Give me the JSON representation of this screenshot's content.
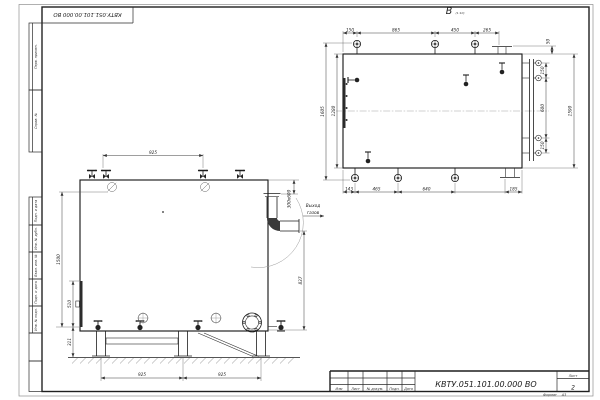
{
  "drawing": {
    "top_stamp_designation": "КВТУ.051.101.00.000 ВО"
  },
  "side_labels": [
    "Перв. примен.",
    "Справ. №",
    "Подп. и дата",
    "Инв. № дубл.",
    "Взам. инв. №",
    "Подп. и дата",
    "Инв. № подл."
  ],
  "view_b": {
    "label": "В",
    "label_note": "(1:10)",
    "dims_top": [
      "150",
      "865",
      "450",
      "265"
    ],
    "dim_flange_offset": "50",
    "dims_right": [
      "150",
      "600",
      "150"
    ],
    "dim_right_overall": "1590",
    "dims_left": [
      "1605",
      "1280"
    ],
    "dims_bottom": [
      "143",
      "465",
      "640",
      "185"
    ]
  },
  "view_front": {
    "dim_top": "925",
    "dim_left_overall": "1500",
    "dims_left": [
      "510",
      "311"
    ],
    "dim_right": "837",
    "dim_outlet": "300х600",
    "dims_bottom": [
      "925",
      "925"
    ],
    "outlet_note": [
      "Выход",
      "газов"
    ]
  },
  "title_block": {
    "designation": "КВТУ.051.101.00.000 ВО",
    "columns": [
      "Изм",
      "Лист",
      "№ докум.",
      "Подп.",
      "Дата"
    ],
    "sheet_label": "Лист",
    "sheet_number": "2",
    "format_label": "Формат",
    "format_value": "А3"
  }
}
